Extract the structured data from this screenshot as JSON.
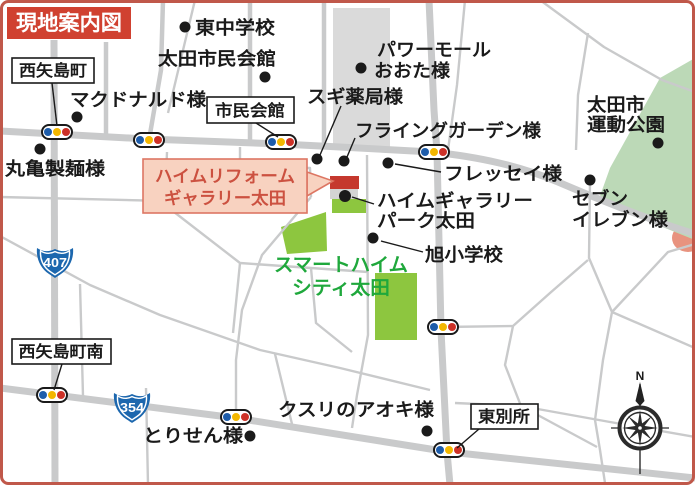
{
  "title": "現地案内図",
  "colors": {
    "map_border": "#c0584a",
    "title_bg": "#d04130",
    "callout_fill": "#f8d2c0",
    "callout_text": "#cc5140",
    "destination_red": "#c5382e",
    "field_green": "#8dc63f",
    "park_green": "#bcd9b7",
    "road_gray": "#c9cacb",
    "signal_blue": "#1d5caa",
    "signal_yellow": "#f3b700",
    "signal_red": "#cd3127",
    "route_sign_blue": "#1c67ae"
  },
  "places": {
    "higashi_junior_high": "東中学校",
    "ota_civic_hall": "太田市民会館",
    "mcdonalds": "マクドナルド様",
    "marugame_seimen": "丸亀製麺様",
    "power_mall_line1": "パワーモール",
    "power_mall_line2": "おおた様",
    "sugi_pharmacy": "スギ薬局様",
    "flying_garden": "フライングガーデン様",
    "fressay": "フレッセイ様",
    "sports_park_line1": "太田市",
    "sports_park_line2": "運動公園",
    "seven_eleven_line1": "セブン",
    "seven_eleven_line2": "イレブン様",
    "heim_gallery_park_line1": "ハイムギャラリー",
    "heim_gallery_park_line2": "パーク太田",
    "asahi_elementary": "旭小学校",
    "smart_heim_line1": "スマートハイム",
    "smart_heim_line2": "シティ太田",
    "torisen": "とりせん様",
    "kusuri_no_aoki": "クスリのアオキ様"
  },
  "intersections": {
    "nishiyajima": "西矢島町",
    "civic_hall": "市民会館",
    "nishiyajima_minami": "西矢島町南",
    "higashi_bessho": "東別所"
  },
  "destination_callout": {
    "line1": "ハイムリフォーム",
    "line2": "ギャラリー太田"
  },
  "route_shields": {
    "route_407": "407",
    "route_354": "354"
  },
  "compass": {
    "north_label": "N"
  }
}
